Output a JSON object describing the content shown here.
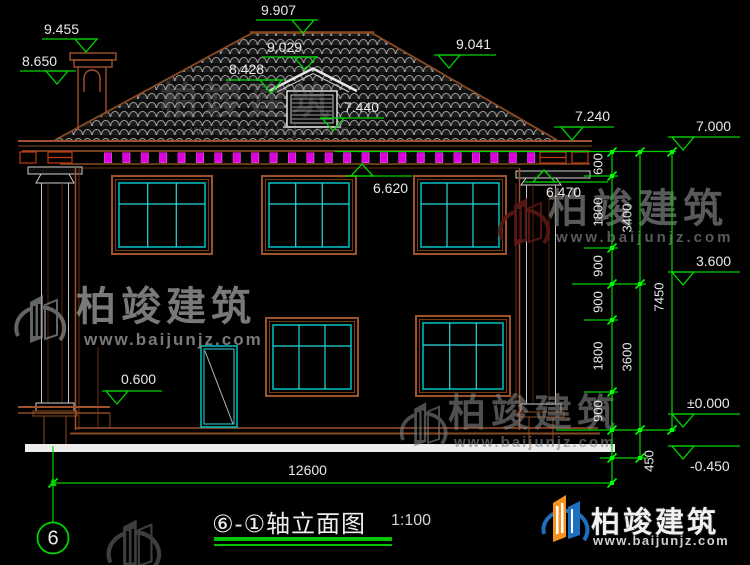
{
  "titleblock": {
    "title": "⑥-①轴立面图",
    "scale": "1:100",
    "axis_no": "6"
  },
  "levels": {
    "chimney_top": "9.455",
    "chimney_cap": "8.650",
    "ridge": "9.907",
    "dormer_ridge": "9.029",
    "dormer_eave": "8.428",
    "dormer_sill": "7.440",
    "roof_slope": "9.041",
    "eave_top": "7.240",
    "parapet": "7.000",
    "eave_soffit": "6.620",
    "capital_top": "6.470",
    "floor2": "3.600",
    "floor1": "±0.000",
    "grade": "-0.450",
    "porch": "0.600"
  },
  "dims": {
    "v_segments": [
      "600",
      "1800",
      "900",
      "900",
      "1800",
      "900"
    ],
    "v_foot": "450",
    "v_floors": [
      "3400",
      "3600"
    ],
    "v_total": "7450",
    "width_total": "12600"
  },
  "watermark": {
    "brand": "柏竣建筑",
    "url": "www.baijunjz.com"
  },
  "logo": {
    "brand": "柏竣建筑",
    "url": "www.baijunjz.com"
  },
  "colors": {
    "dim_green": "#00d400",
    "line_brown": "#a0522d",
    "window_cyan": "#00c2c2",
    "dentil_magenta": "#dc00dc",
    "logo_blue": "#1e6fbf",
    "logo_orange": "#f6921e"
  }
}
